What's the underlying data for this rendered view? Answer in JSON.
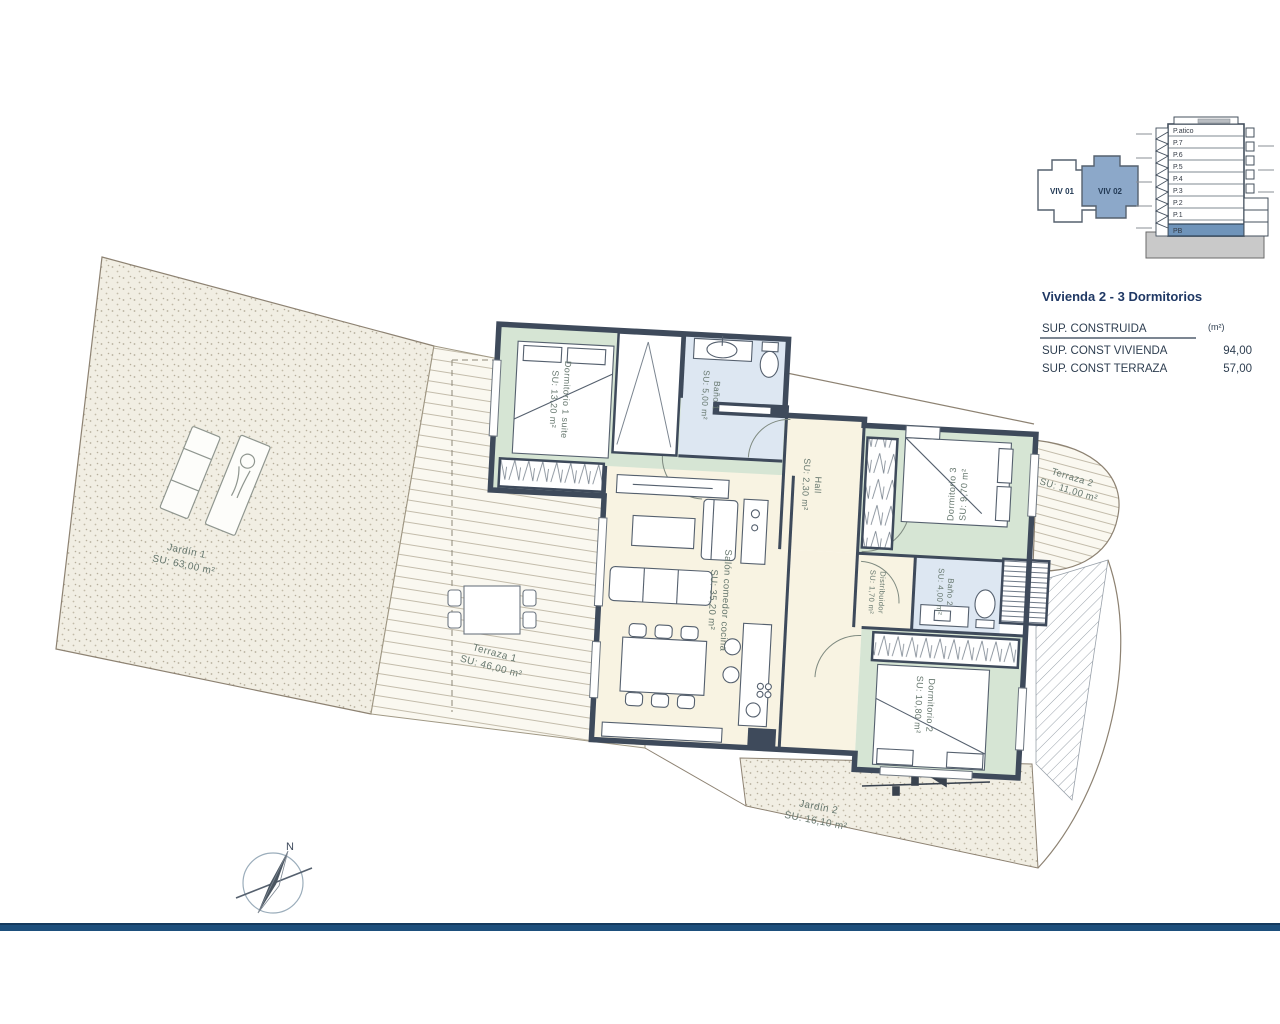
{
  "info_panel": {
    "title": "Vivienda 2 - 3 Dormitorios",
    "table": {
      "header": "SUP. CONSTRUIDA",
      "header_unit": "(m²)",
      "rows": [
        {
          "label": "SUP. CONST VIVIENDA",
          "value": "94,00"
        },
        {
          "label": "SUP. CONST TERRAZA",
          "value": "57,00"
        }
      ]
    },
    "key_plan": {
      "units": [
        {
          "label": "VIV 01",
          "selected": false
        },
        {
          "label": "VIV 02",
          "selected": true
        }
      ]
    },
    "elevation": {
      "floors": [
        "P.atico",
        "P.7",
        "P.6",
        "P.5",
        "P.4",
        "P.3",
        "P.2",
        "P.1",
        "PB"
      ],
      "highlighted_floor": "PB"
    }
  },
  "plan": {
    "compass_label": "N",
    "rooms": [
      {
        "name": "Dormitorio 1 suite",
        "su": "SU:  13,20 m²"
      },
      {
        "name": "Baño 1",
        "su": "SU:  5,00 m²"
      },
      {
        "name": "Hall",
        "su": "SU:  2,30 m²"
      },
      {
        "name": "Dormitorio 3",
        "su": "SU:  9,70 m²"
      },
      {
        "name": "Terraza 2",
        "su": "SU:  11,00 m²"
      },
      {
        "name": "Distribuidor",
        "su": "SU:  1,70 m²"
      },
      {
        "name": "Baño 2",
        "su": "SU:  4,00 m²"
      },
      {
        "name": "Dormitorio 2",
        "su": "SU:  10,80 m²"
      },
      {
        "name": "Salón comedor cocina",
        "su": "SU:  35,20 m²"
      },
      {
        "name": "Terraza 1",
        "su": "SU:  46,00 m²"
      },
      {
        "name": "Jardín 1",
        "su": "SU:  63,00 m²"
      },
      {
        "name": "Jardín 2",
        "su": "SU:  16,10 m²"
      }
    ]
  },
  "colors": {
    "footer_bar": "#1d4f7c",
    "selected_unit": "#8ca8c9",
    "highlight_floor": "#6f94ba",
    "wall": "#3e4a5b",
    "bedroom_fill": "#d6e5d4",
    "bath_fill": "#dde7f2",
    "living_fill": "#f8f3e2",
    "label_text": "#66776e",
    "title_text": "#1f3864"
  }
}
